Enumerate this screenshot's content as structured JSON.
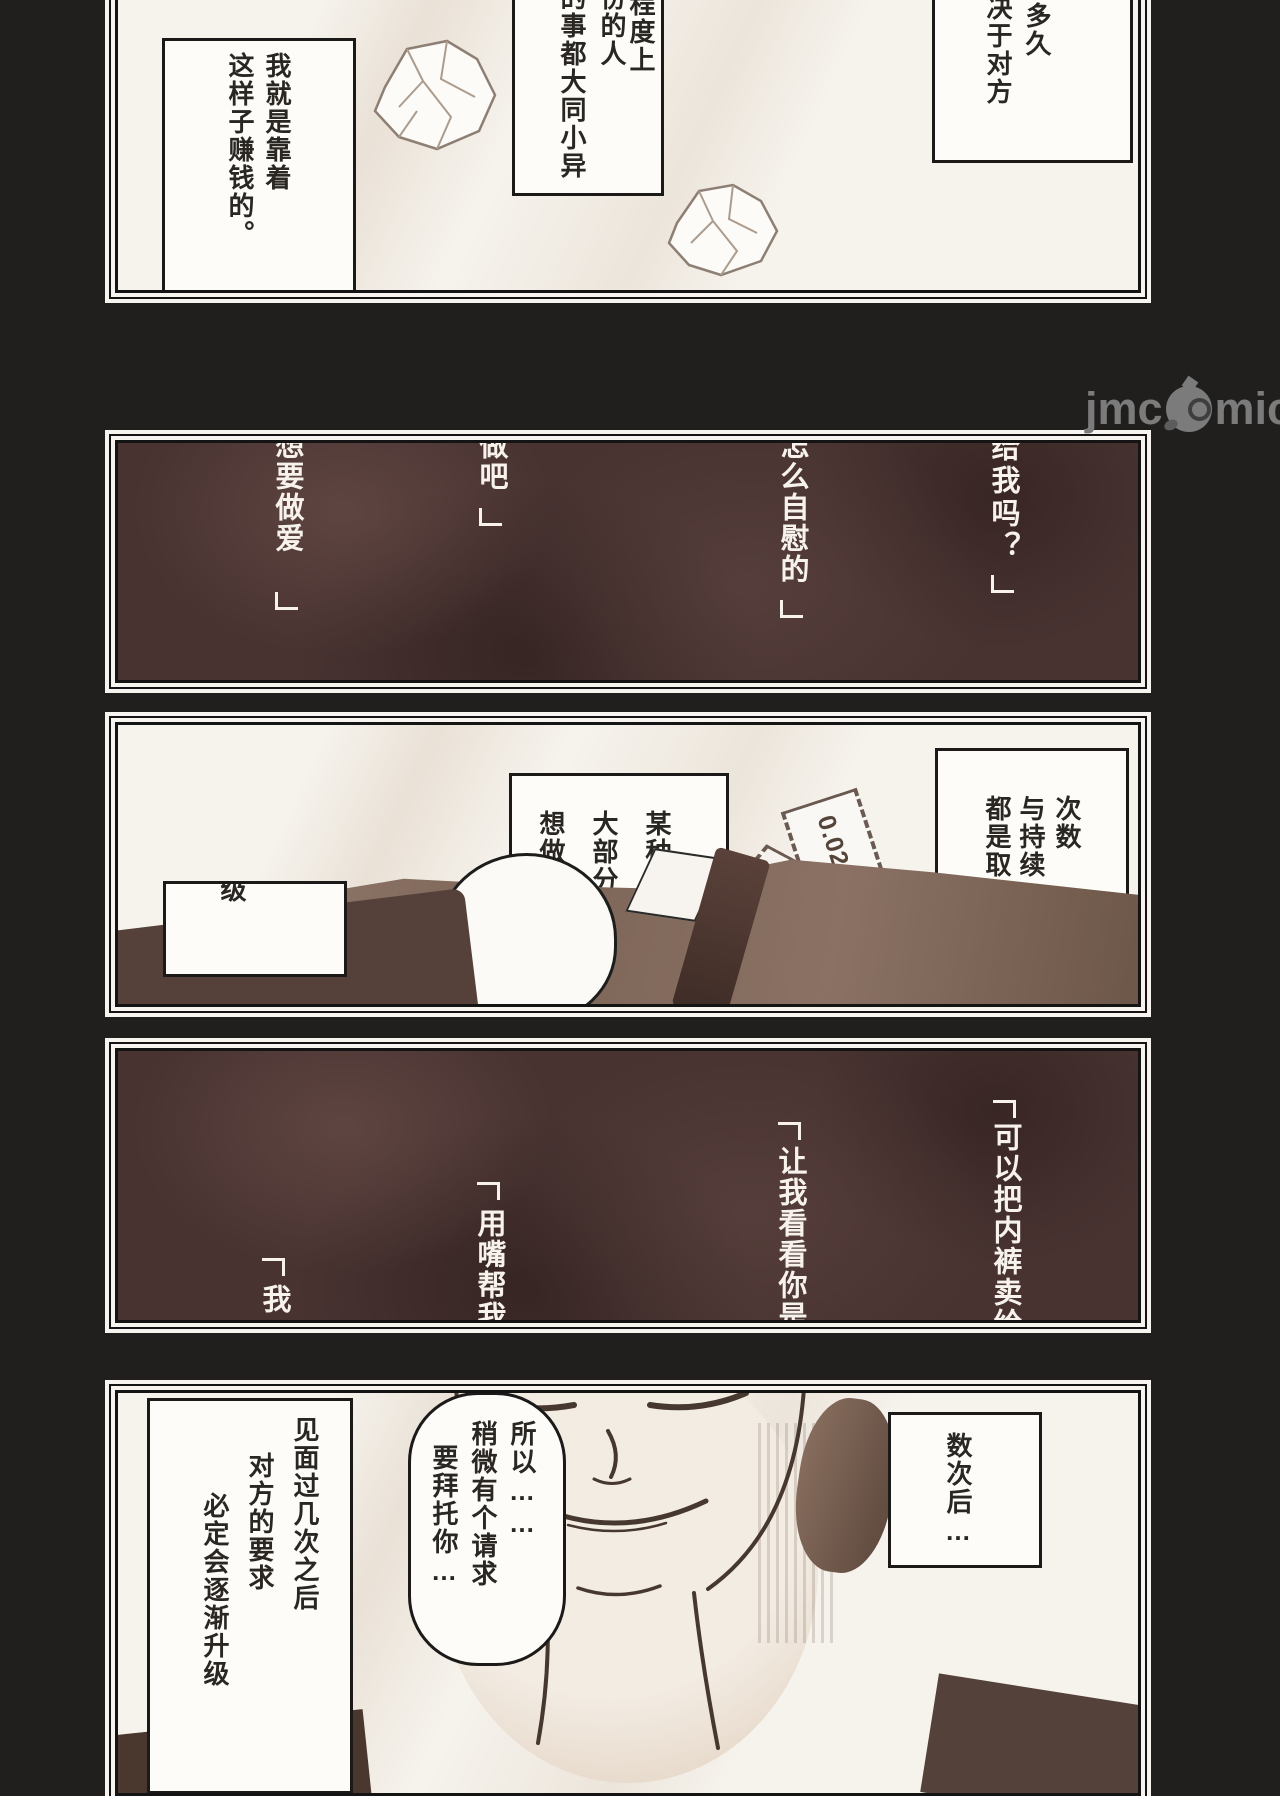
{
  "canvas": {
    "bg": "#201f1d"
  },
  "watermark": {
    "left": "jmc",
    "right": "mic",
    "icon": "bird-mascot-icon",
    "color": "#7b7b7b"
  },
  "colors": {
    "panel_light": "#f6f3ed",
    "panel_dark": "#483331",
    "ink_text": "#2a2723",
    "white_text": "#f7f2ec",
    "figure_brown": "#7c6457",
    "tie_brown": "#4a342c"
  },
  "panel1": {
    "bubble_left": {
      "cols": [
        "我就是靠着",
        "这样子赚钱的。"
      ]
    },
    "bubble_mid": {
      "cols": [
        "程度上",
        "份的人",
        "的事都大同小异"
      ]
    },
    "bubble_right": {
      "cols": [
        "多久",
        "决于对方"
      ]
    },
    "props": [
      "crumpled-paper",
      "crumpled-paper"
    ]
  },
  "panel2": {
    "close_bracket": "」",
    "cols": [
      "给我吗？",
      "怎么自慰的",
      "做吧",
      "想要做爱"
    ]
  },
  "panel3": {
    "bubble_mid": {
      "cols": [
        "某种程",
        "大部分",
        "想做的"
      ]
    },
    "bubble_right": {
      "cols": [
        "次数",
        "与持续",
        "都是取"
      ]
    },
    "box_left": {
      "cols": [
        "级"
      ]
    },
    "condom_label": "0.02"
  },
  "panel4": {
    "open_bracket": "「",
    "cols": [
      "可以把内裤卖给",
      "让我看看你是怎",
      "用嘴帮我做",
      "我"
    ]
  },
  "panel5": {
    "bubble_right": {
      "cols": [
        "数次后…"
      ]
    },
    "bubble_mid": {
      "cols": [
        "所以……",
        "稍微有个请求",
        "要拜托你…"
      ]
    },
    "box_left": {
      "cols": [
        "见面过几次之后",
        "对方的要求",
        "必定会逐渐升级"
      ]
    }
  }
}
